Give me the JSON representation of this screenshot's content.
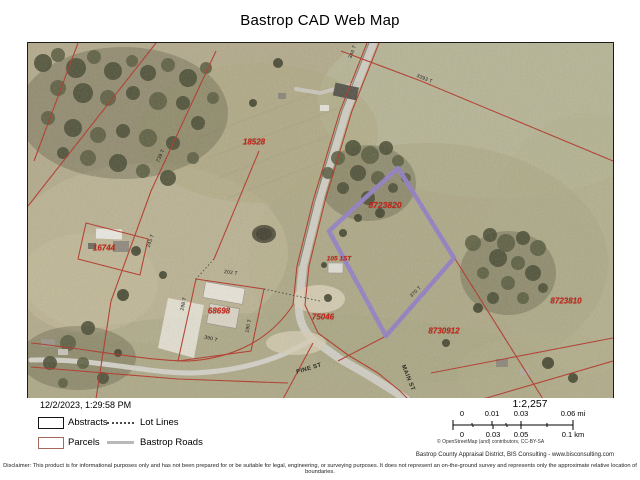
{
  "title": "Bastrop CAD Web Map",
  "generated_at": "12/2/2023, 1:29:58 PM",
  "legend": {
    "items": [
      {
        "label": "Abstracts",
        "swatch": "black-outline-rect"
      },
      {
        "label": "Lot Lines",
        "swatch": "dotted-line"
      },
      {
        "label": "Parcels",
        "swatch": "red-outline-rect"
      },
      {
        "label": "Bastrop Roads",
        "swatch": "gray-line"
      }
    ]
  },
  "scalebar": {
    "ratio": "1:2,257",
    "mi": [
      "0",
      "0.01",
      "0.03",
      "0.06 mi"
    ],
    "km": [
      "0",
      "0.03",
      "0.05",
      "0.1 km"
    ]
  },
  "attribution": "© OpenStreetMap (and) contributors, CC-BY-SA",
  "credit": "Bastrop County Appraisal District, BIS Consulting - www.bisconsulting.com",
  "disclaimer": "Disclaimer: This product is for informational purposes only and has not been prepared for or be suitable for legal, engineering, or surveying purposes. It does not represent an on-the-ground survey and represents only the approximate relative location of boundaries.",
  "map": {
    "selected_parcel_id": "8723820",
    "parcel_labels": [
      {
        "text": "18528"
      },
      {
        "text": "16744"
      },
      {
        "text": "68698"
      },
      {
        "text": "75046"
      },
      {
        "text": "8730912"
      },
      {
        "text": "8723810"
      },
      {
        "text": "8723820"
      },
      {
        "text": "105 1ST"
      }
    ],
    "road_labels": [
      {
        "text": "PINE ST"
      },
      {
        "text": "MAIN ST"
      }
    ],
    "dimension_labels": [
      {
        "text": "3393 T"
      },
      {
        "text": "346 T"
      },
      {
        "text": "739 T"
      },
      {
        "text": "245 T"
      },
      {
        "text": "298 T"
      },
      {
        "text": "390 T"
      },
      {
        "text": "370 T"
      },
      {
        "text": "202 T"
      },
      {
        "text": "190 T"
      }
    ],
    "colors": {
      "parcel_line": "#b23527",
      "selected_outline": "#9180c4",
      "parcel_label": "#c2251a",
      "road_fill": "#cfccc2"
    }
  }
}
